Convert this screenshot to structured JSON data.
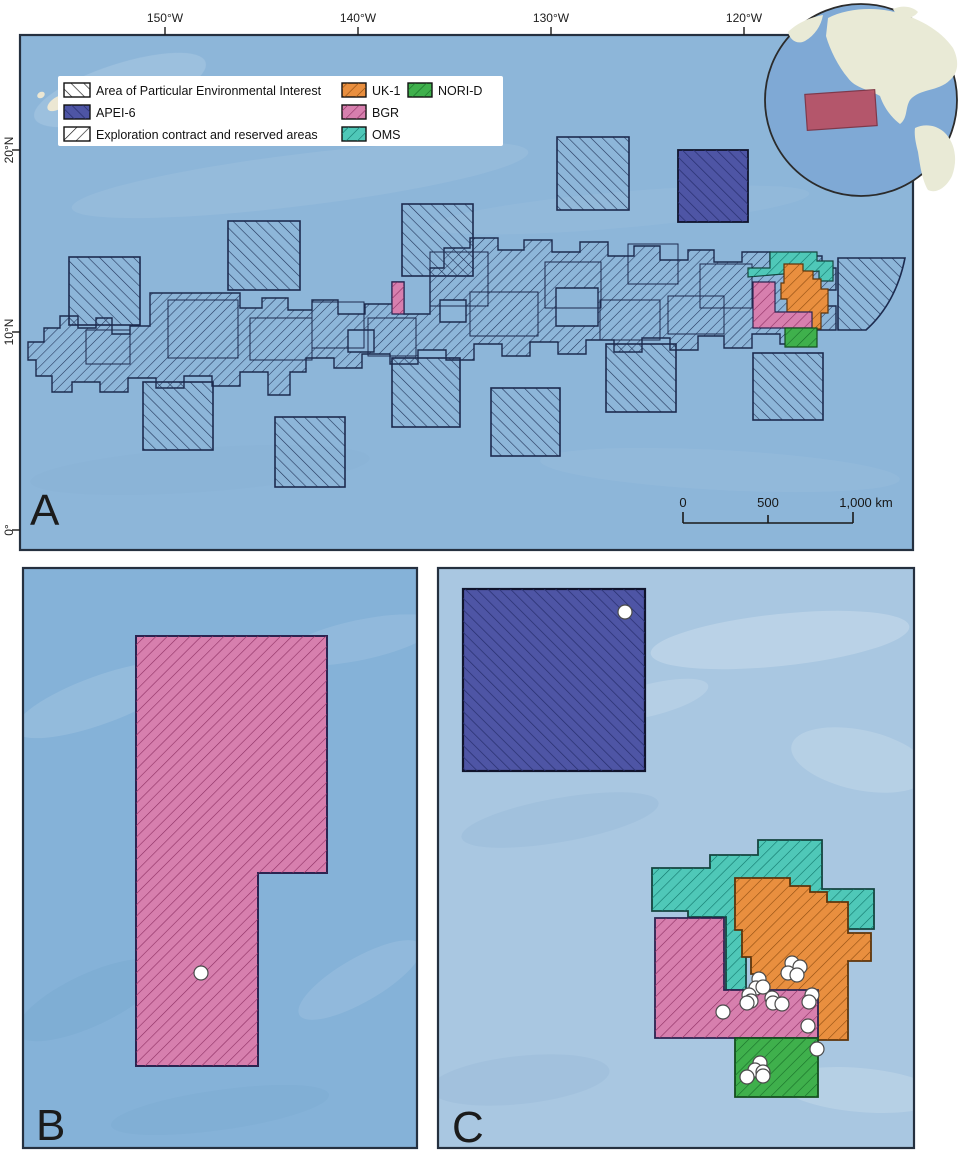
{
  "panels": {
    "a": {
      "label": "A",
      "x_ticks": [
        "150°W",
        "140°W",
        "130°W",
        "120°W"
      ],
      "y_ticks": [
        "20°N",
        "10°N",
        "0°"
      ],
      "legend": {
        "items": [
          {
            "label": "Area of Particular Environmental Interest"
          },
          {
            "label": "APEI-6"
          },
          {
            "label": "Exploration contract and reserved areas"
          },
          {
            "label": "UK-1"
          },
          {
            "label": "BGR"
          },
          {
            "label": "OMS"
          },
          {
            "label": "NORI-D"
          }
        ]
      },
      "scale_bar": {
        "labels": [
          "0",
          "500",
          "1,000 km"
        ]
      }
    },
    "b": {
      "label": "B"
    },
    "c": {
      "label": "C"
    }
  },
  "colors": {
    "ocean_a": "#8db6d9",
    "ocean_b": "#85b2d8",
    "ocean_c": "#a9c7e1",
    "apei6": "#4e55a5",
    "uk1": "#e98f3f",
    "bgr": "#d77fae",
    "oms": "#4fc8b8",
    "norid": "#3fb04c",
    "legend_bg": "#ffffff",
    "land": "#e9ead6",
    "globe_ocean": "#7fa9d5",
    "globe_highlight": "#b94f63",
    "hawaii": "#ece7d3",
    "station": "#ffffff"
  },
  "stations": {
    "panel_b": [
      [
        201,
        973
      ]
    ],
    "panel_c": [
      [
        625,
        612
      ],
      [
        792,
        963
      ],
      [
        800,
        967
      ],
      [
        788,
        973
      ],
      [
        797,
        975
      ],
      [
        759,
        979
      ],
      [
        756,
        988
      ],
      [
        763,
        987
      ],
      [
        749,
        995
      ],
      [
        772,
        998
      ],
      [
        751,
        1001
      ],
      [
        747,
        1003
      ],
      [
        773,
        1003
      ],
      [
        782,
        1004
      ],
      [
        812,
        995
      ],
      [
        809,
        1002
      ],
      [
        723,
        1012
      ],
      [
        808,
        1026
      ],
      [
        817,
        1049
      ],
      [
        760,
        1063
      ],
      [
        755,
        1070
      ],
      [
        763,
        1072
      ],
      [
        747,
        1077
      ],
      [
        763,
        1076
      ]
    ]
  }
}
